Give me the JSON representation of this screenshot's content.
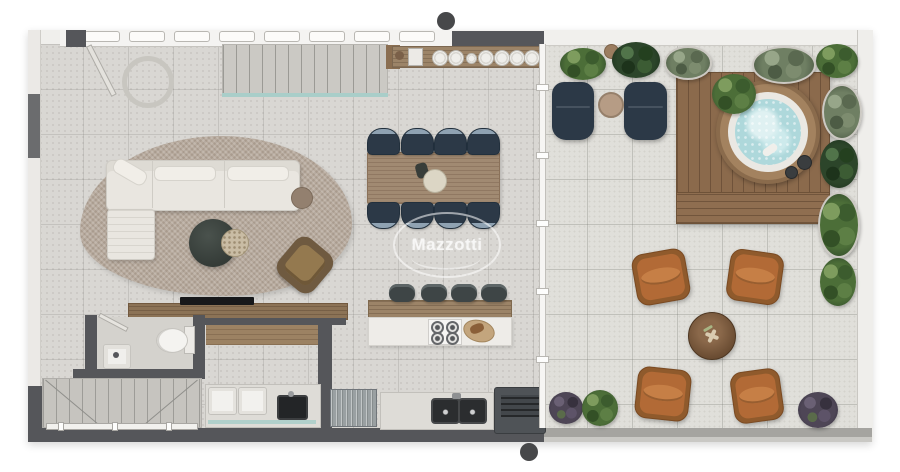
{
  "watermark": {
    "brand": "Mazzotti"
  },
  "palette": {
    "wall_light": "#f0efec",
    "wall_dark": "#55565a",
    "floor_interior": "#d9d7d3",
    "floor_terrace": "#e0dfda",
    "counter": "#dedcd7",
    "wood": "#9c8468",
    "wood_deck": "#8b6a4c",
    "sofa_cream": "#e9e6e0",
    "rug_taupe": "#b7aa9d",
    "navy": "#2c3947",
    "navy_trim": "#8fa2b2",
    "cognac": "#b26a36",
    "cognac_light": "#c67f46",
    "water": "#aed8db",
    "water_light": "#dff1f2",
    "glass": "#a9cec9",
    "leaf": "#4c6e38",
    "leaf_dark": "#30492a",
    "plant_purple": "#4e4656",
    "steel": "#9aa0a2",
    "fixture_white": "#f4f3f0",
    "table_dark": "#343b37",
    "bowl_tan": "#c9bca4",
    "marker_gray": "#47484a"
  },
  "scene": {
    "type": "apartment-floor-plan-render",
    "areas": [
      {
        "name": "living-room",
        "items": [
          "area-rug",
          "sectional-sofa",
          "chaise",
          "coffee-table",
          "decor-bowl",
          "side-table",
          "armchair",
          "tv-console",
          "tv"
        ]
      },
      {
        "name": "dining-area",
        "items": [
          "wood-dining-table",
          "dining-chair x8",
          "centerpiece-plate"
        ]
      },
      {
        "name": "kitchen",
        "items": [
          "island-with-cooktop",
          "bar-stool x4",
          "cutting-board",
          "double-sink",
          "stainless-appliance",
          "grill"
        ]
      },
      {
        "name": "bathroom",
        "items": [
          "toilet",
          "washbasin",
          "door"
        ]
      },
      {
        "name": "laundry",
        "items": [
          "washer",
          "dryer",
          "utility-sink"
        ]
      },
      {
        "name": "circulation",
        "items": [
          "upper-stair-flight",
          "lower-stair-flight",
          "glass-railing",
          "entry-door",
          "round-skylight",
          "buffet-shelf-with-plates"
        ]
      },
      {
        "name": "terrace",
        "items": [
          "sun-lounger x2",
          "lounger-side-table",
          "wood-deck",
          "hot-tub",
          "planter x10",
          "fire-pit-table",
          "cognac-armchair x4",
          "potted-plant x3",
          "glass-partition"
        ]
      }
    ],
    "markers": [
      "top-section-marker",
      "bottom-section-marker"
    ]
  }
}
